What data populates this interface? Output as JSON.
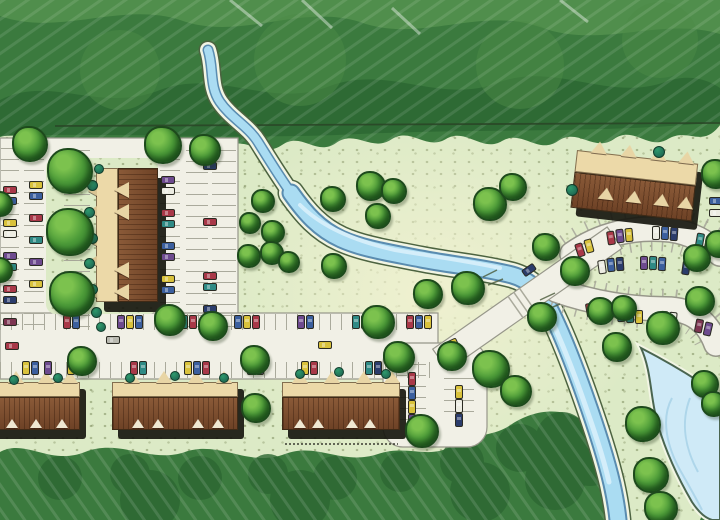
{
  "palette": {
    "base": {
      "lawn": "#dceac6",
      "forest": "#3b7a3e",
      "forestDark": "#2d6732",
      "forestLight": "#629e57",
      "road": "#f1f0e6",
      "roadEdge": "#97978a",
      "tick": "#aaaa9c",
      "streamEdge": "#4c6340",
      "bank": "#f2f5e4",
      "water": "#aadcf2",
      "waterDark": "#5a8cb0",
      "waterLight": "#d8effb",
      "pond": "#cfeaf7",
      "pondEdge": "#4a6550",
      "pondLine": "#aed6ea",
      "tan": "#ecd9a8",
      "tanLight": "#e8d5a5",
      "brown1": "#8a5a38",
      "brown2": "#6e4226",
      "outline": "#3f2a16",
      "shadow": "#17170f"
    },
    "cars": {
      "red": "#a83848",
      "blu": "#3b5f9e",
      "sky": "#6e9cc4",
      "tea": "#2f8a85",
      "yel": "#d9c23c",
      "pur": "#6d4a8e",
      "whi": "#ecece2",
      "nvy": "#2b3c6b",
      "mar": "#7d3551",
      "gry": "#b9b9b0"
    }
  },
  "scene": {
    "trees": [
      [
        30,
        144,
        36
      ],
      [
        163,
        145,
        38
      ],
      [
        205,
        150,
        32
      ],
      [
        70,
        171,
        46
      ],
      [
        70,
        232,
        48
      ],
      [
        72,
        294,
        46
      ],
      [
        0,
        204,
        26
      ],
      [
        0,
        270,
        26
      ],
      [
        170,
        320,
        32
      ],
      [
        213,
        326,
        30
      ],
      [
        82,
        361,
        30
      ],
      [
        255,
        360,
        30
      ],
      [
        378,
        322,
        34
      ],
      [
        263,
        201,
        24
      ],
      [
        250,
        223,
        22
      ],
      [
        273,
        232,
        24
      ],
      [
        249,
        256,
        24
      ],
      [
        272,
        253,
        24
      ],
      [
        289,
        262,
        22
      ],
      [
        333,
        199,
        26
      ],
      [
        334,
        266,
        26
      ],
      [
        371,
        186,
        30
      ],
      [
        394,
        191,
        26
      ],
      [
        378,
        216,
        26
      ],
      [
        490,
        204,
        34
      ],
      [
        513,
        187,
        28
      ],
      [
        546,
        247,
        28
      ],
      [
        428,
        294,
        30
      ],
      [
        468,
        288,
        34
      ],
      [
        399,
        357,
        32
      ],
      [
        452,
        356,
        30
      ],
      [
        491,
        369,
        38
      ],
      [
        516,
        391,
        32
      ],
      [
        422,
        431,
        34
      ],
      [
        256,
        408,
        30
      ],
      [
        542,
        317,
        30
      ],
      [
        575,
        271,
        30
      ],
      [
        601,
        311,
        28
      ],
      [
        624,
        308,
        26
      ],
      [
        663,
        328,
        34
      ],
      [
        700,
        301,
        30
      ],
      [
        697,
        258,
        28
      ],
      [
        617,
        347,
        30
      ],
      [
        643,
        424,
        36
      ],
      [
        651,
        475,
        36
      ],
      [
        661,
        508,
        34
      ],
      [
        705,
        384,
        28
      ],
      [
        714,
        404,
        26
      ],
      [
        716,
        174,
        30
      ],
      [
        719,
        244,
        28
      ]
    ],
    "shrubs": [
      [
        92,
        185,
        11
      ],
      [
        89,
        212,
        11
      ],
      [
        92,
        238,
        11
      ],
      [
        89,
        263,
        11
      ],
      [
        92,
        289,
        11
      ],
      [
        96,
        312,
        11
      ],
      [
        99,
        169,
        10
      ],
      [
        101,
        327,
        10
      ],
      [
        572,
        190,
        12
      ],
      [
        659,
        152,
        12
      ],
      [
        14,
        380,
        10
      ],
      [
        58,
        378,
        10
      ],
      [
        130,
        378,
        10
      ],
      [
        175,
        376,
        10
      ],
      [
        224,
        378,
        10
      ],
      [
        300,
        374,
        10
      ],
      [
        339,
        372,
        10
      ],
      [
        386,
        374,
        10
      ]
    ],
    "cars": [
      [
        3,
        186,
        "h",
        "red"
      ],
      [
        3,
        197,
        "h",
        "blu"
      ],
      [
        3,
        219,
        "h",
        "yel"
      ],
      [
        3,
        230,
        "h",
        "whi"
      ],
      [
        3,
        252,
        "h",
        "pur"
      ],
      [
        3,
        263,
        "h",
        "tea"
      ],
      [
        3,
        285,
        "h",
        "red"
      ],
      [
        3,
        296,
        "h",
        "nvy"
      ],
      [
        3,
        318,
        "h",
        "mar"
      ],
      [
        29,
        181,
        "h",
        "yel"
      ],
      [
        29,
        192,
        "h",
        "blu"
      ],
      [
        29,
        214,
        "h",
        "red"
      ],
      [
        29,
        236,
        "h",
        "tea"
      ],
      [
        29,
        258,
        "h",
        "pur"
      ],
      [
        29,
        280,
        "h",
        "yel"
      ],
      [
        161,
        176,
        "h",
        "pur"
      ],
      [
        161,
        187,
        "h",
        "whi"
      ],
      [
        161,
        209,
        "h",
        "red"
      ],
      [
        161,
        220,
        "h",
        "tea"
      ],
      [
        161,
        242,
        "h",
        "blu"
      ],
      [
        161,
        253,
        "h",
        "pur"
      ],
      [
        161,
        275,
        "h",
        "yel"
      ],
      [
        161,
        286,
        "h",
        "blu"
      ],
      [
        161,
        308,
        "h",
        "tea"
      ],
      [
        203,
        162,
        "h",
        "nvy"
      ],
      [
        203,
        218,
        "h",
        "red"
      ],
      [
        203,
        272,
        "h",
        "red"
      ],
      [
        203,
        283,
        "h",
        "tea"
      ],
      [
        203,
        305,
        "h",
        "nvy"
      ],
      [
        106,
        336,
        "h",
        "gry"
      ],
      [
        5,
        342,
        "h",
        "red"
      ],
      [
        318,
        341,
        "h",
        "yel"
      ],
      [
        63,
        315,
        "v",
        "red"
      ],
      [
        72,
        315,
        "v",
        "blu"
      ],
      [
        117,
        315,
        "v",
        "pur"
      ],
      [
        126,
        315,
        "v",
        "yel"
      ],
      [
        135,
        315,
        "v",
        "blu"
      ],
      [
        180,
        315,
        "v",
        "tea"
      ],
      [
        189,
        315,
        "v",
        "red"
      ],
      [
        234,
        315,
        "v",
        "blu"
      ],
      [
        243,
        315,
        "v",
        "yel"
      ],
      [
        252,
        315,
        "v",
        "red"
      ],
      [
        297,
        315,
        "v",
        "pur"
      ],
      [
        306,
        315,
        "v",
        "blu"
      ],
      [
        352,
        315,
        "v",
        "tea"
      ],
      [
        361,
        315,
        "v",
        "mar"
      ],
      [
        406,
        315,
        "v",
        "red"
      ],
      [
        415,
        315,
        "v",
        "blu"
      ],
      [
        424,
        315,
        "v",
        "yel"
      ],
      [
        22,
        361,
        "v",
        "yel"
      ],
      [
        31,
        361,
        "v",
        "blu"
      ],
      [
        44,
        361,
        "v",
        "pur"
      ],
      [
        67,
        361,
        "v",
        "yel"
      ],
      [
        130,
        361,
        "v",
        "red"
      ],
      [
        139,
        361,
        "v",
        "tea"
      ],
      [
        184,
        361,
        "v",
        "yel"
      ],
      [
        193,
        361,
        "v",
        "blu"
      ],
      [
        202,
        361,
        "v",
        "red"
      ],
      [
        247,
        361,
        "v",
        "blu"
      ],
      [
        256,
        361,
        "v",
        "pur"
      ],
      [
        301,
        361,
        "v",
        "yel"
      ],
      [
        310,
        361,
        "v",
        "red"
      ],
      [
        365,
        361,
        "v",
        "tea"
      ],
      [
        374,
        361,
        "v",
        "nvy"
      ],
      [
        408,
        372,
        "v",
        "red"
      ],
      [
        408,
        386,
        "v",
        "blu"
      ],
      [
        408,
        400,
        "v",
        "yel"
      ],
      [
        408,
        414,
        "v",
        "pur"
      ],
      [
        455,
        385,
        "v",
        "yel"
      ],
      [
        455,
        399,
        "v",
        "whi"
      ],
      [
        455,
        413,
        "v",
        "nvy"
      ],
      [
        444,
        340,
        "h",
        "yel",
        -25
      ],
      [
        522,
        266,
        "h",
        "nvy",
        -35
      ],
      [
        576,
        243,
        "v",
        "red",
        -18
      ],
      [
        585,
        239,
        "v",
        "yel",
        -15
      ],
      [
        607,
        231,
        "v",
        "red",
        -9
      ],
      [
        616,
        229,
        "v",
        "pur",
        -7
      ],
      [
        625,
        228,
        "v",
        "yel",
        -5
      ],
      [
        652,
        226,
        "v",
        "whi",
        0
      ],
      [
        661,
        226,
        "v",
        "blu",
        2
      ],
      [
        670,
        227,
        "v",
        "nvy",
        4
      ],
      [
        696,
        233,
        "v",
        "tea",
        10
      ],
      [
        705,
        236,
        "v",
        "pur",
        12
      ],
      [
        598,
        260,
        "v",
        "whi",
        -8
      ],
      [
        607,
        258,
        "v",
        "blu",
        -6
      ],
      [
        616,
        257,
        "v",
        "nvy",
        -4
      ],
      [
        640,
        256,
        "v",
        "pur",
        0
      ],
      [
        649,
        256,
        "v",
        "tea",
        2
      ],
      [
        658,
        257,
        "v",
        "blu",
        3
      ],
      [
        682,
        261,
        "v",
        "nvy",
        8
      ],
      [
        586,
        303,
        "v",
        "red",
        -10
      ],
      [
        595,
        305,
        "v",
        "yel",
        -8
      ],
      [
        617,
        308,
        "v",
        "blu",
        -4
      ],
      [
        626,
        309,
        "v",
        "tea",
        -2
      ],
      [
        635,
        310,
        "v",
        "yel",
        0
      ],
      [
        660,
        311,
        "v",
        "pur",
        4
      ],
      [
        669,
        312,
        "v",
        "whi",
        6
      ],
      [
        695,
        319,
        "v",
        "mar",
        11
      ],
      [
        704,
        322,
        "v",
        "pur",
        13
      ],
      [
        709,
        197,
        "h",
        "blu"
      ],
      [
        709,
        209,
        "h",
        "whi"
      ]
    ]
  }
}
